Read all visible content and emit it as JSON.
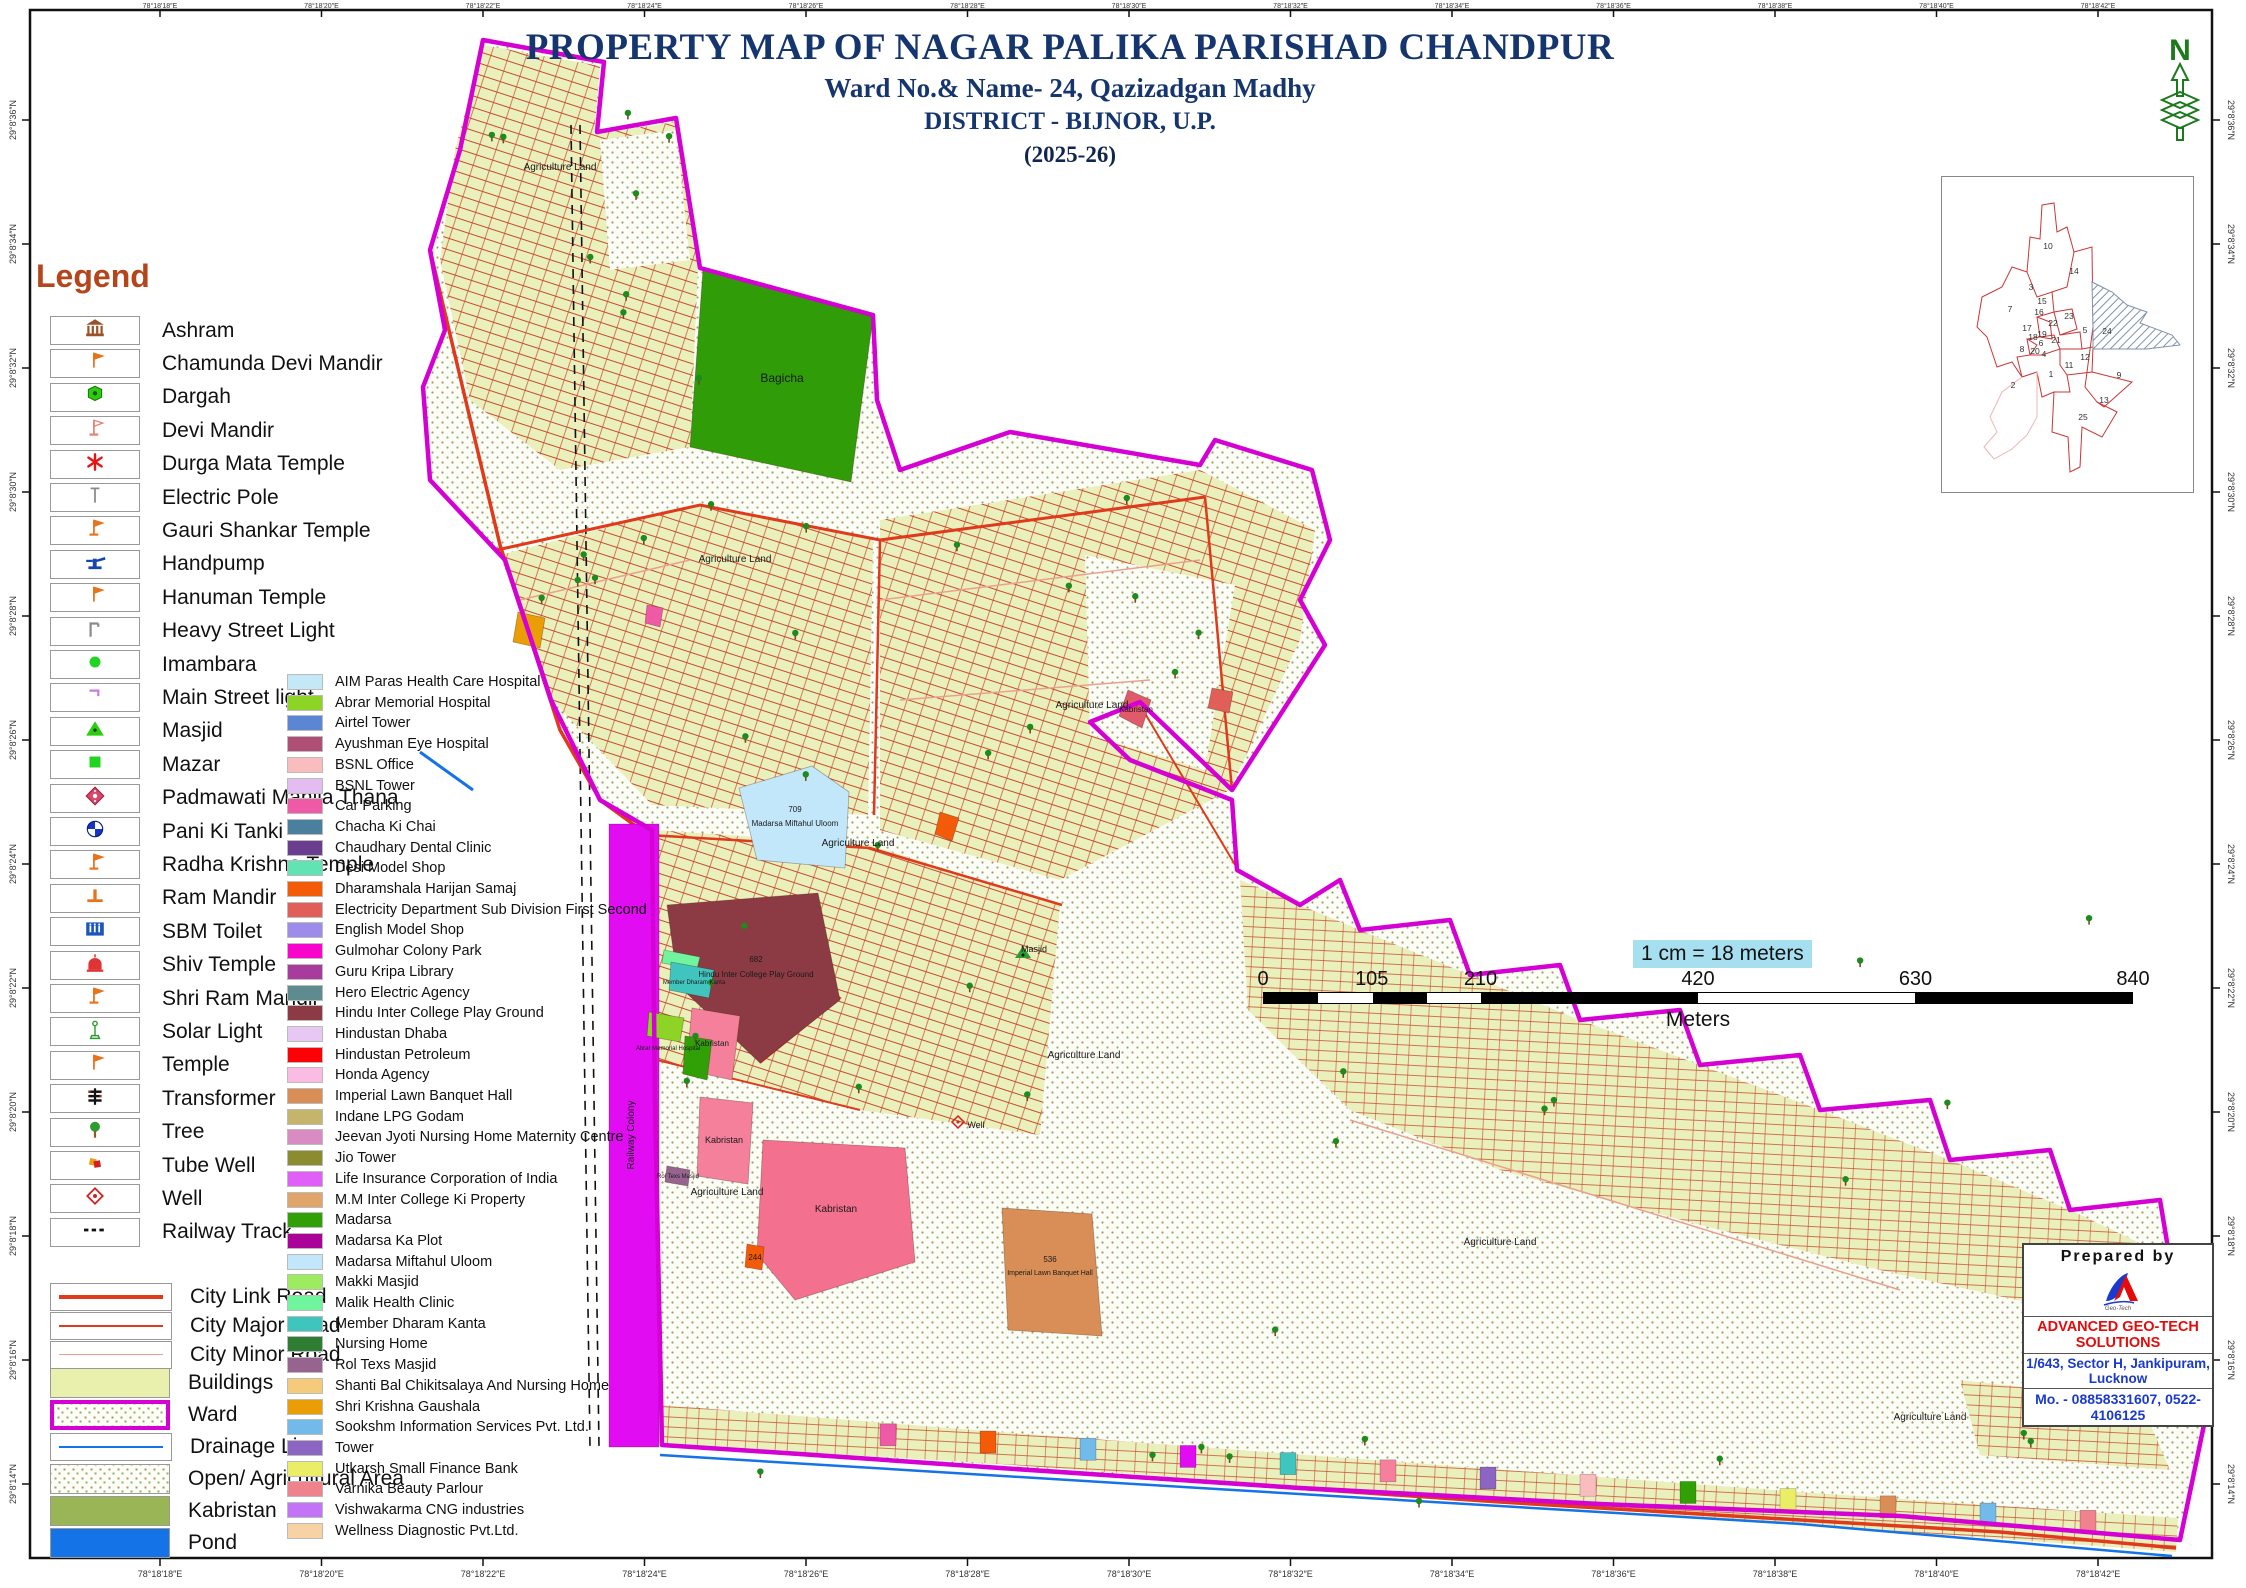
{
  "title": {
    "line1": "PROPERTY MAP OF NAGAR PALIKA PARISHAD CHANDPUR",
    "line2": "Ward No.& Name- 24, Qazizadgan Madhy",
    "line3": "DISTRICT - BIJNOR, U.P.",
    "line4": "(2025-26)"
  },
  "north_arrow_label": "N",
  "legend": {
    "heading": "Legend",
    "point_items": [
      {
        "icon": "ashram-icon",
        "label": "Ashram"
      },
      {
        "icon": "flag-icon",
        "label": "Chamunda Devi Mandir"
      },
      {
        "icon": "dargah-icon",
        "label": "Dargah"
      },
      {
        "icon": "flag-outline-icon",
        "label": "Devi Mandir"
      },
      {
        "icon": "asterisk-icon",
        "label": "Durga Mata Temple"
      },
      {
        "icon": "pole-icon",
        "label": "Electric Pole"
      },
      {
        "icon": "flag-base-icon",
        "label": "Gauri Shankar Temple"
      },
      {
        "icon": "handpump-icon",
        "label": "Handpump"
      },
      {
        "icon": "flag-icon",
        "label": "Hanuman Temple"
      },
      {
        "icon": "streetlight-icon",
        "label": "Heavy Street Light"
      },
      {
        "icon": "circle-icon",
        "label": "Imambara"
      },
      {
        "icon": "mainlight-icon",
        "label": "Main Street light"
      },
      {
        "icon": "masjid-icon",
        "label": "Masjid"
      },
      {
        "icon": "mazar-icon",
        "label": "Mazar"
      },
      {
        "icon": "thana-icon",
        "label": "Padmawati Mahila Thana"
      },
      {
        "icon": "tanki-icon",
        "label": "Pani Ki Tanki"
      },
      {
        "icon": "flag-base-icon",
        "label": "Radha Krishna Temple"
      },
      {
        "icon": "rammandir-icon",
        "label": "Ram Mandir"
      },
      {
        "icon": "toilet-icon",
        "label": "SBM Toilet"
      },
      {
        "icon": "shiv-icon",
        "label": "Shiv Temple"
      },
      {
        "icon": "flag-base-icon",
        "label": "Shri Ram Mandir"
      },
      {
        "icon": "solar-icon",
        "label": "Solar Light"
      },
      {
        "icon": "flag-icon",
        "label": "Temple"
      },
      {
        "icon": "transformer-icon",
        "label": "Transformer"
      },
      {
        "icon": "tree-icon",
        "label": "Tree"
      },
      {
        "icon": "tubewell-icon",
        "label": "Tube Well"
      },
      {
        "icon": "well-icon",
        "label": "Well"
      },
      {
        "icon": "railway-icon",
        "label": "Railway Track"
      }
    ],
    "road_items": [
      {
        "label": "City Link Road",
        "color": "#e0391c",
        "weight": 4
      },
      {
        "label": "City Major Road",
        "color": "#e0391c",
        "weight": 2
      },
      {
        "label": "City Minor Road",
        "color": "#eba08e",
        "weight": 1.5
      }
    ],
    "area_items": [
      {
        "label": "Buildings",
        "style": "fill",
        "color": "#e9efad"
      },
      {
        "label": "Ward",
        "style": "ward",
        "color": "#d400d4"
      },
      {
        "label": "Drainage Line",
        "style": "line",
        "color": "#1473e6"
      },
      {
        "label": "Open/ Agricultural Area",
        "style": "dots",
        "color": "#fdfdf8"
      },
      {
        "label": "Kabristan",
        "style": "fill",
        "color": "#9ab556"
      },
      {
        "label": "Pond",
        "style": "fill",
        "color": "#1473e6"
      }
    ]
  },
  "building_legend": [
    {
      "label": "AIM Paras Health Care Hospital",
      "color": "#c5e8f7"
    },
    {
      "label": "Abrar  Memorial Hospital",
      "color": "#8ed426"
    },
    {
      "label": "Airtel Tower",
      "color": "#5b86d4"
    },
    {
      "label": "Ayushman Eye Hospital",
      "color": "#b04f75"
    },
    {
      "label": "BSNL Office",
      "color": "#f9bcbf"
    },
    {
      "label": "BSNL Tower",
      "color": "#e3bdf2"
    },
    {
      "label": "Car Parking",
      "color": "#ef5aa7"
    },
    {
      "label": "Chacha Ki Chai",
      "color": "#4b7f9e"
    },
    {
      "label": "Chaudhary Dental Clinic",
      "color": "#6a3d8f"
    },
    {
      "label": "Desi Model Shop",
      "color": "#62e3b4"
    },
    {
      "label": "Dharamshala Harijan Samaj",
      "color": "#f35b08"
    },
    {
      "label": "Electricity Department Sub Division First Second",
      "color": "#e05f58"
    },
    {
      "label": "English Model Shop",
      "color": "#9e8cea"
    },
    {
      "label": "Gulmohar Colony Park",
      "color": "#f705cb"
    },
    {
      "label": "Guru Kripa Library",
      "color": "#a83b9d"
    },
    {
      "label": "Hero Electric Agency",
      "color": "#5e8b8d"
    },
    {
      "label": "Hindu Inter College Play Ground",
      "color": "#8c3b45"
    },
    {
      "label": "Hindustan Dhaba",
      "color": "#e7c8f5"
    },
    {
      "label": "Hindustan Petroleum",
      "color": "#fb0207"
    },
    {
      "label": "Honda Agency",
      "color": "#fbbce4"
    },
    {
      "label": "Imperial Lawn Banquet Hall",
      "color": "#d98e57"
    },
    {
      "label": "Indane LPG Godam",
      "color": "#c4b56a"
    },
    {
      "label": "Jeevan Jyoti Nursing Home Maternity Centre",
      "color": "#d98cc4"
    },
    {
      "label": "Jio Tower",
      "color": "#8b8c30"
    },
    {
      "label": "Life Insurance Corporation of India",
      "color": "#e060f7"
    },
    {
      "label": "M.M Inter College Ki Property",
      "color": "#dfa56a"
    },
    {
      "label": "Madarsa",
      "color": "#31a007"
    },
    {
      "label": "Madarsa Ka Plot",
      "color": "#aa0397"
    },
    {
      "label": "Madarsa Miftahul Uloom",
      "color": "#c2e6fa"
    },
    {
      "label": "Makki Masjid",
      "color": "#9deb5e"
    },
    {
      "label": "Malik Health Clinic",
      "color": "#70f59e"
    },
    {
      "label": "Member Dharam Kanta",
      "color": "#3fc4be"
    },
    {
      "label": "Nursing Home",
      "color": "#2f7d33"
    },
    {
      "label": "Rol Texs Masjid",
      "color": "#97648f"
    },
    {
      "label": "Shanti Bal Chikitsalaya And Nursing Home",
      "color": "#f6ca7b"
    },
    {
      "label": "Shri Krishna Gaushala",
      "color": "#eb9d06"
    },
    {
      "label": "Sookshm Information Services Pvt. Ltd.",
      "color": "#72bae9"
    },
    {
      "label": "Tower",
      "color": "#8b65c1"
    },
    {
      "label": "Utkarsh Small Finance Bank",
      "color": "#e9ee66"
    },
    {
      "label": "Varnika Beauty Parlour",
      "color": "#f0828e"
    },
    {
      "label": "Vishwakarma CNG industries",
      "color": "#c273f7"
    },
    {
      "label": "Wellness Diagnostic Pvt.Ltd.",
      "color": "#f6d2a4"
    }
  ],
  "scale_bar": {
    "note": "1 cm = 18 meters",
    "ticks": [
      0,
      105,
      210,
      420,
      630,
      840
    ],
    "tick_pos": [
      0,
      12.5,
      25,
      50,
      75,
      100
    ],
    "segments": [
      {
        "from": 0,
        "to": 6.25,
        "color": "#000"
      },
      {
        "from": 6.25,
        "to": 12.5,
        "color": "#fff"
      },
      {
        "from": 12.5,
        "to": 18.75,
        "color": "#000"
      },
      {
        "from": 18.75,
        "to": 25,
        "color": "#fff"
      },
      {
        "from": 25,
        "to": 50,
        "color": "#000"
      },
      {
        "from": 50,
        "to": 75,
        "color": "#fff"
      },
      {
        "from": 75,
        "to": 100,
        "color": "#000"
      }
    ],
    "unit": "Meters"
  },
  "prepared_by": {
    "heading": "Prepared  by",
    "company": "ADVANCED GEO-TECH SOLUTIONS",
    "address": "1/643, Sector H, Jankipuram, Lucknow",
    "phone": "Mo. - 08858331607, 0522-4106125"
  },
  "frame": {
    "lon_labels": [
      "78°18'18″E",
      "78°18'20″E",
      "78°18'22″E",
      "78°18'24″E",
      "78°18'26″E",
      "78°18'28″E",
      "78°18'30″E",
      "78°18'32″E",
      "78°18'34″E",
      "78°18'36″E",
      "78°18'38″E",
      "78°18'40″E",
      "78°18'42″E"
    ],
    "lat_labels": [
      "29°8'36″N",
      "29°8'34″N",
      "29°8'32″N",
      "29°8'30″N",
      "29°8'28″N",
      "29°8'26″N",
      "29°8'24″N",
      "29°8'22″N",
      "29°8'20″N",
      "29°8'18″N",
      "29°8'16″N",
      "29°8'14″N"
    ]
  },
  "inset": {
    "wards": [
      {
        "n": "10",
        "x": 106,
        "y": 72
      },
      {
        "n": "14",
        "x": 132,
        "y": 97
      },
      {
        "n": "3",
        "x": 89,
        "y": 113
      },
      {
        "n": "15",
        "x": 100,
        "y": 127
      },
      {
        "n": "7",
        "x": 68,
        "y": 135
      },
      {
        "n": "16",
        "x": 97,
        "y": 138
      },
      {
        "n": "23",
        "x": 127,
        "y": 142
      },
      {
        "n": "22",
        "x": 111,
        "y": 149
      },
      {
        "n": "17",
        "x": 85,
        "y": 154
      },
      {
        "n": "5",
        "x": 143,
        "y": 156
      },
      {
        "n": "24",
        "x": 165,
        "y": 157
      },
      {
        "n": "19",
        "x": 100,
        "y": 160
      },
      {
        "n": "18",
        "x": 91,
        "y": 163
      },
      {
        "n": "21",
        "x": 114,
        "y": 166
      },
      {
        "n": "6",
        "x": 99,
        "y": 169
      },
      {
        "n": "8",
        "x": 80,
        "y": 175
      },
      {
        "n": "20",
        "x": 93,
        "y": 177
      },
      {
        "n": "4",
        "x": 102,
        "y": 180
      },
      {
        "n": "12",
        "x": 143,
        "y": 183
      },
      {
        "n": "11",
        "x": 127,
        "y": 191
      },
      {
        "n": "1",
        "x": 109,
        "y": 200
      },
      {
        "n": "9",
        "x": 177,
        "y": 201
      },
      {
        "n": "2",
        "x": 71,
        "y": 211
      },
      {
        "n": "13",
        "x": 162,
        "y": 226
      },
      {
        "n": "25",
        "x": 141,
        "y": 243
      }
    ]
  },
  "map": {
    "features": [
      {
        "name": "railway-colony-strip",
        "color": "#e10cf2",
        "points": "609,824 659,824 659,1447 609,1447"
      },
      {
        "name": "bagicha-garden",
        "color": "#2f9c08",
        "points": "703,270 873,317 851,482 690,447"
      },
      {
        "name": "madarsa-miftahul-uloom-pond",
        "color": "#c2e6fa",
        "points": "739,788 812,766 849,792 845,868 757,860"
      },
      {
        "name": "hindu-inter-college-play-ground",
        "color": "#8c3b45",
        "points": "667,905 818,893 840,1000 760,1063 678,985"
      },
      {
        "name": "malik-health-clinic",
        "color": "#70f59e",
        "points": "664,950 700,957 697,969 662,963"
      },
      {
        "name": "member-dharam-kanta",
        "color": "#3fc4be",
        "points": "671,962 714,970 709,998 669,990"
      },
      {
        "name": "abrar-memorial-hospital",
        "color": "#8ed426",
        "points": "649,1012 684,1018 680,1042 647,1036"
      },
      {
        "name": "kabristan-a",
        "color": "#f4809c",
        "points": "692,1008 740,1016 732,1080 686,1070"
      },
      {
        "name": "bagicha-2",
        "color": "#31a007",
        "points": "685,1036 712,1040 707,1080 683,1074"
      },
      {
        "name": "kabristan-c",
        "color": "#f4809c",
        "points": "700,1097 753,1103 748,1184 697,1176"
      },
      {
        "name": "kabristan-b",
        "color": "#f4708f",
        "points": "763,1140 905,1148 915,1262 795,1300 757,1254"
      },
      {
        "name": "imperial-lawn-banquet-hall",
        "color": "#d98e57",
        "points": "1002,1208 1092,1214 1102,1336 1008,1330"
      },
      {
        "name": "kabristan-diamond",
        "color": "#e05b6a",
        "points": "1128,690 1151,700 1142,728 1119,716"
      },
      {
        "name": "plot-244",
        "color": "#f35b08",
        "points": "747,1244 764,1247 762,1270 745,1267"
      },
      {
        "name": "rol-texs-masjid",
        "color": "#97648f",
        "points": "667,1166 690,1170 688,1186 665,1182"
      },
      {
        "name": "shri-krishna-gaushala",
        "color": "#eb9d06",
        "points": "518,612 545,618 540,648 513,642"
      },
      {
        "name": "orange-dharamshala",
        "color": "#f35b08",
        "points": "940,812 959,818 952,841 935,834"
      },
      {
        "name": "car-parking-dot",
        "color": "#ef5aa7",
        "points": "647,605 663,608 660,627 645,623"
      },
      {
        "name": "electricity-dept",
        "color": "#e05f58",
        "points": "1212,688 1233,692 1229,713 1208,708"
      }
    ],
    "labels": [
      {
        "text": "Bagicha",
        "x": 782,
        "y": 382,
        "size": 12
      },
      {
        "text": "709",
        "x": 795,
        "y": 812,
        "size": 8
      },
      {
        "text": "Madarsa Miftahul Uloom",
        "x": 795,
        "y": 826,
        "size": 8
      },
      {
        "text": "682",
        "x": 756,
        "y": 962,
        "size": 8
      },
      {
        "text": "Hindu Inter College Play Ground",
        "x": 756,
        "y": 977,
        "size": 8
      },
      {
        "text": "Kabristan",
        "x": 712,
        "y": 1046,
        "size": 8
      },
      {
        "text": "Kabristan",
        "x": 724,
        "y": 1143,
        "size": 9
      },
      {
        "text": "Kabristan",
        "x": 836,
        "y": 1212,
        "size": 10
      },
      {
        "text": "Kabristan",
        "x": 1136,
        "y": 712,
        "size": 8
      },
      {
        "text": "536",
        "x": 1050,
        "y": 1262,
        "size": 8
      },
      {
        "text": "Imperial Lawn Banquet Hall",
        "x": 1050,
        "y": 1275,
        "size": 7
      },
      {
        "text": "Agriculture Land",
        "x": 560,
        "y": 170,
        "size": 10
      },
      {
        "text": "Agriculture Land",
        "x": 735,
        "y": 562,
        "size": 10
      },
      {
        "text": "Agriculture Land",
        "x": 858,
        "y": 846,
        "size": 10
      },
      {
        "text": "Agriculture Land",
        "x": 1092,
        "y": 708,
        "size": 10
      },
      {
        "text": "Agriculture Land",
        "x": 1084,
        "y": 1058,
        "size": 10
      },
      {
        "text": "Agriculture Land",
        "x": 727,
        "y": 1195,
        "size": 10
      },
      {
        "text": "Agriculture Land",
        "x": 1500,
        "y": 1245,
        "size": 10
      },
      {
        "text": "Agriculture Land",
        "x": 1930,
        "y": 1420,
        "size": 10
      },
      {
        "text": "Railway Colony",
        "x": 634,
        "y": 1135,
        "size": 10,
        "rotate": -90
      },
      {
        "text": "Well",
        "x": 976,
        "y": 1128,
        "size": 9
      },
      {
        "text": "Masjid",
        "x": 1034,
        "y": 952,
        "size": 9
      },
      {
        "text": "Abrar  Memorial Hospital",
        "x": 668,
        "y": 1050,
        "size": 6
      },
      {
        "text": "Member Dharam Kanta",
        "x": 694,
        "y": 984,
        "size": 6
      },
      {
        "text": "244",
        "x": 755,
        "y": 1260,
        "size": 8
      },
      {
        "text": "Rol Texs Masjid",
        "x": 678,
        "y": 1178,
        "size": 6
      }
    ],
    "band_accents": [
      "#ef5aa7",
      "#f35b08",
      "#72bae9",
      "#e10cf2",
      "#3fc4be",
      "#f4809c",
      "#8b65c1",
      "#f9bcbf",
      "#31a007",
      "#e9ee66",
      "#d98e57",
      "#72bae9",
      "#f0828e"
    ],
    "tree_zones": [
      [
        480,
        90,
        220,
        340,
        9
      ],
      [
        530,
        500,
        340,
        310,
        10
      ],
      [
        660,
        840,
        390,
        290,
        8
      ],
      [
        900,
        480,
        380,
        380,
        8
      ],
      [
        1260,
        900,
        880,
        560,
        10
      ],
      [
        700,
        1408,
        1380,
        100,
        9
      ]
    ]
  }
}
